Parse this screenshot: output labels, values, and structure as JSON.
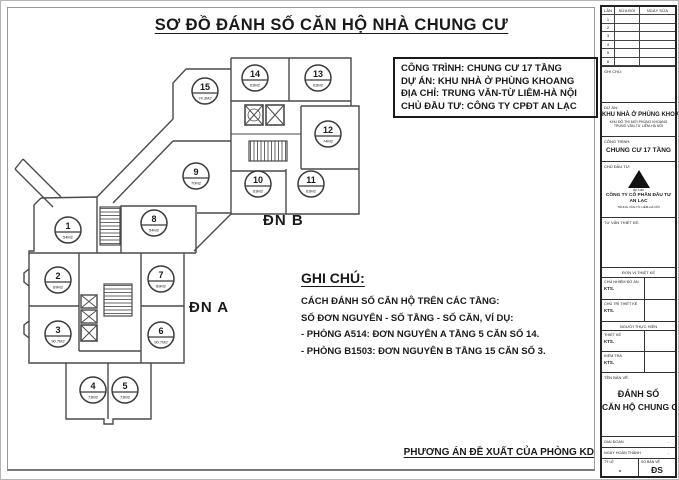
{
  "title": "SƠ ĐỒ ĐÁNH SỐ CĂN HỘ NHÀ CHUNG CƯ",
  "info_box": {
    "lines": [
      "CÔNG TRÌNH: CHUNG CƯ 17 TẦNG",
      "DỰ ÁN: KHU NHÀ Ở PHÙNG KHOANG",
      "ĐỊA CHỈ: TRUNG VĂN-TỪ LIÊM-HÀ NỘI",
      "CHỦ ĐẦU TƯ: CÔNG TY CPĐT AN LẠC"
    ]
  },
  "plan": {
    "unit_a_label": "ĐN A",
    "unit_b_label": "ĐN B",
    "apartments": [
      {
        "no": "1",
        "area": "54M2",
        "x": 67,
        "y": 229
      },
      {
        "no": "2",
        "area": "69M2",
        "x": 57,
        "y": 279
      },
      {
        "no": "3",
        "area": "90.7M2",
        "x": 57,
        "y": 333
      },
      {
        "no": "4",
        "area": "73M2",
        "x": 92,
        "y": 389
      },
      {
        "no": "5",
        "area": "73M2",
        "x": 124,
        "y": 389
      },
      {
        "no": "6",
        "area": "90.7M2",
        "x": 160,
        "y": 334
      },
      {
        "no": "7",
        "area": "69M2",
        "x": 160,
        "y": 278
      },
      {
        "no": "8",
        "area": "54M2",
        "x": 153,
        "y": 222
      },
      {
        "no": "9",
        "area": "70M2",
        "x": 195,
        "y": 175
      },
      {
        "no": "10",
        "area": "63M2",
        "x": 257,
        "y": 183
      },
      {
        "no": "11",
        "area": "63M2",
        "x": 310,
        "y": 183
      },
      {
        "no": "12",
        "area": "74M2",
        "x": 327,
        "y": 133
      },
      {
        "no": "13",
        "area": "63M2",
        "x": 317,
        "y": 77
      },
      {
        "no": "14",
        "area": "63M2",
        "x": 254,
        "y": 77
      },
      {
        "no": "15",
        "area": "74.3M2",
        "x": 204,
        "y": 90
      }
    ]
  },
  "notes": {
    "heading": "GHI CHÚ:",
    "lines": [
      "CÁCH ĐÁNH SỐ CĂN HỘ TRÊN CÁC TẦNG:",
      "SỐ ĐƠN NGUYÊN - SỐ TẦNG - SỐ CĂN, VÍ DỤ:",
      "- PHÒNG A514: ĐƠN NGUYÊN A TẦNG 5 CĂN SỐ 14.",
      "- PHÒNG B1503: ĐƠN NGUYÊN B TẦNG 15 CĂN SỐ 3."
    ]
  },
  "footer_note": "PHƯƠNG ÁN ĐỀ XUẤT CỦA PHÒNG KD",
  "title_block": {
    "revision_table": {
      "headers": [
        "LẦN",
        "SỬA ĐỔI",
        "NGÀY SỬA"
      ],
      "rows": [
        "1",
        "2",
        "3",
        "4",
        "5",
        "6"
      ]
    },
    "note_label": "GHI CHÚ:",
    "project": {
      "label": "DỰ ÁN:",
      "name": "KHU NHÀ Ở PHÙNG KHOANG",
      "sub": "KHU ĐÔ THỊ MỚI PHÙNG KHOANG TRUNG VĂN-TỪ LIÊM-HÀ NỘI"
    },
    "building": {
      "label": "CÔNG TRÌNH:",
      "name": "CHUNG CƯ 17 TẦNG"
    },
    "investor": {
      "label": "CHỦ ĐẦU TƯ:",
      "logo_caption": "An Lạc",
      "name": "CÔNG TY CỔ PHẦN ĐẦU TƯ AN LẠC",
      "sub": "TRUNG VĂN-TỪ LIÊM-HÀ NỘI"
    },
    "consultant": {
      "label": "TƯ VẤN THIẾT KẾ:"
    },
    "sig_sections": [
      {
        "header": "ĐƠN VỊ THIẾT KẾ",
        "rows": [
          {
            "label": "CHỦ NHIỆM ĐỒ ÁN",
            "name": "KTS."
          },
          {
            "label": "CHỦ TRÌ THIẾT KẾ",
            "name": "KTS."
          }
        ]
      },
      {
        "header": "NGƯỜI THỰC HIỆN",
        "rows": [
          {
            "label": "THIẾT KẾ",
            "name": "KTS."
          },
          {
            "label": "KIỂM TRA",
            "name": "KTS."
          }
        ]
      }
    ],
    "drawing": {
      "label": "TÊN BẢN VẼ:",
      "name_line1": "ĐÁNH SỐ",
      "name_line2": "CĂN HỘ CHUNG CƯ"
    },
    "meta_rows": [
      {
        "label": "GIAI ĐOẠN",
        "value": "-"
      },
      {
        "label": "NGÀY HOÀN THÀNH",
        "value": "-"
      }
    ],
    "scale": {
      "label": "TỶ LỆ",
      "value": "-"
    },
    "sheet": {
      "label": "SỐ BẢN VẼ",
      "value": "ĐS"
    }
  },
  "colors": {
    "ink": "#1a1a1a",
    "wall": "#4a4a4a",
    "paper": "#ffffff"
  }
}
